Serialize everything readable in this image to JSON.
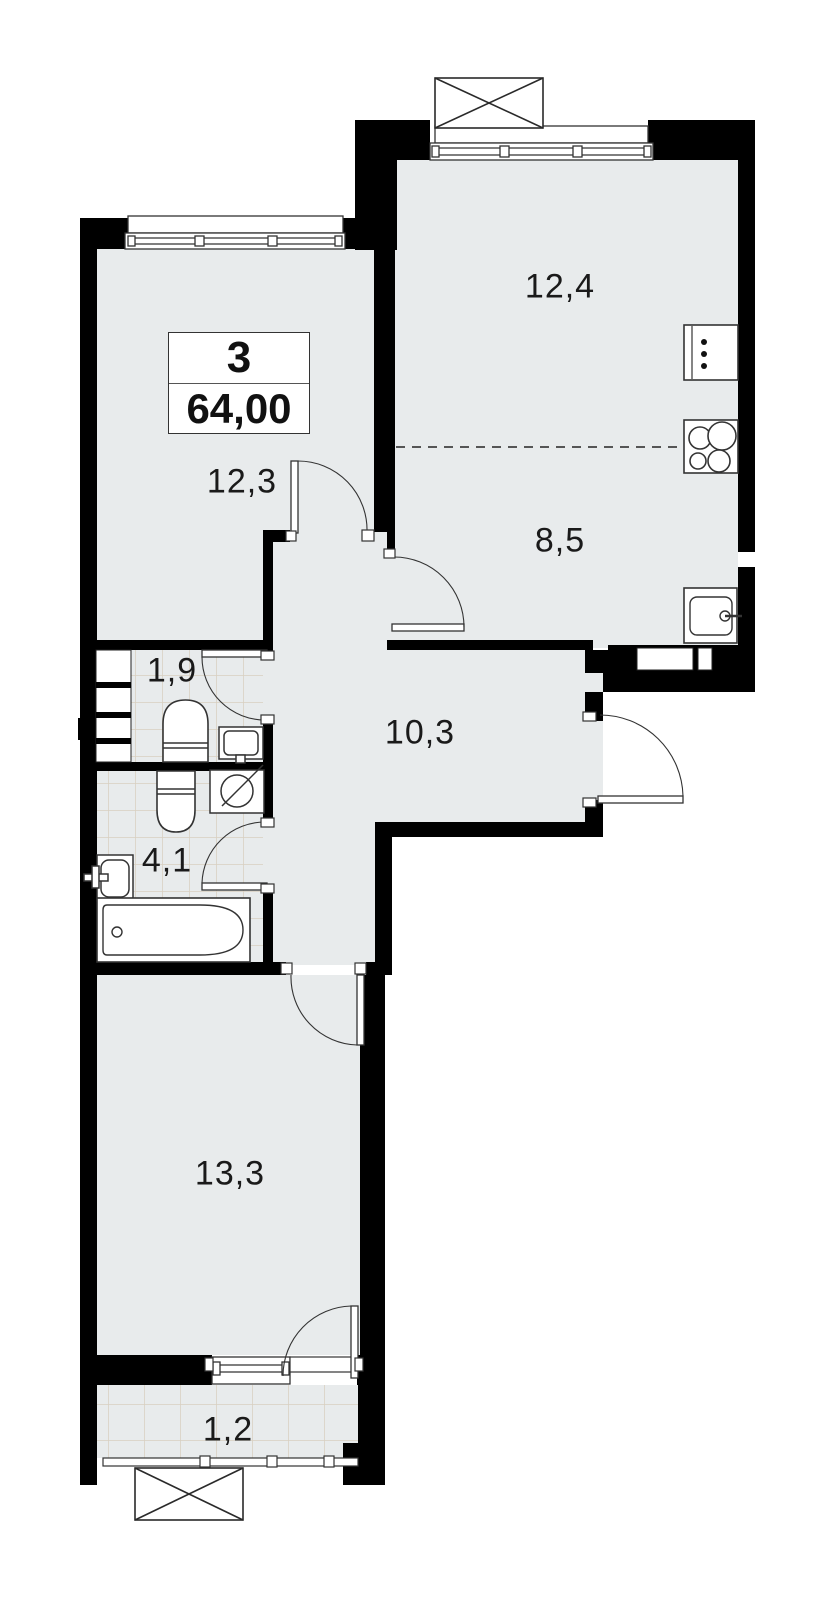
{
  "plan": {
    "type": "apartment-floor-plan",
    "rooms_count": "3",
    "total_area": "64,00",
    "rooms": [
      {
        "id": "living-kitchen-upper",
        "area": "12,4"
      },
      {
        "id": "kitchen-zone",
        "area": "8,5"
      },
      {
        "id": "bedroom-1",
        "area": "12,3"
      },
      {
        "id": "wc",
        "area": "1,9"
      },
      {
        "id": "bathroom",
        "area": "4,1"
      },
      {
        "id": "hallway",
        "area": "10,3"
      },
      {
        "id": "bedroom-2",
        "area": "13,3"
      },
      {
        "id": "balcony",
        "area": "1,2"
      }
    ],
    "fixtures": [
      "window",
      "balcony-hatch",
      "stove-icon",
      "fridge-icon",
      "kitchen-sink-icon",
      "toilet-icon",
      "washbasin-icon",
      "washing-machine-icon",
      "bathtub-icon",
      "door-swing",
      "entrance-door",
      "vent-shaft",
      "kitchen-zone-divider"
    ],
    "colors": {
      "wall": "#000000",
      "floor": "#e8ebec",
      "tile_line": "#d8cfc0",
      "fixture_stroke": "#333333",
      "divider_dash": "#555555"
    }
  }
}
